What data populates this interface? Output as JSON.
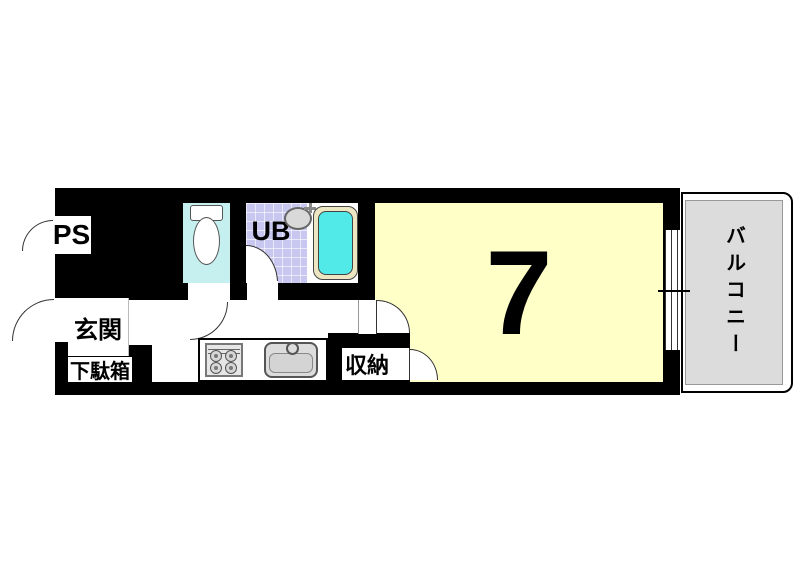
{
  "floorplan": {
    "unit_size_label": "7",
    "rooms": {
      "ps": "PS",
      "entrance": "玄関",
      "shoe_cabinet": "下駄箱",
      "unit_bath": "UB",
      "storage": "収納",
      "balcony": "バルコニー"
    },
    "colors": {
      "wall": "#000000",
      "main_room": "#FFFFC8",
      "toilet_room": "#C6F0F0",
      "bath_tiles": "#C7C7EF",
      "bathtub_rim": "#EDE6C2",
      "bathtub_water": "#52E9E9",
      "balcony": "#DCDCDC",
      "fixtures": "#DCDCDC",
      "background": "#FFFFFF"
    }
  }
}
